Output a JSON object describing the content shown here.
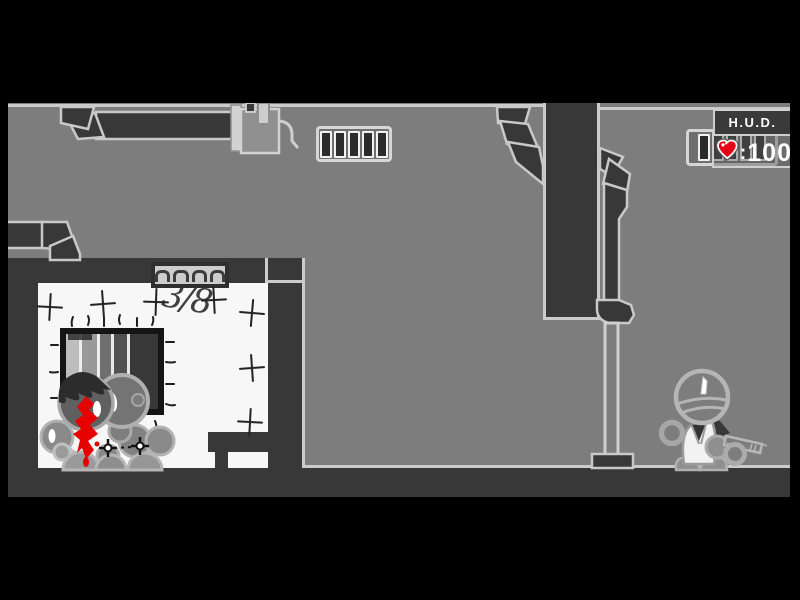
{
  "game": {
    "hud": {
      "title": "H.U.D.",
      "health_separator": ":",
      "health_value": "100",
      "heart_icon": "heart-health-icon",
      "heart_color": "#e60016"
    },
    "wall_text": "3/8",
    "vents": {
      "slot_count": 5
    },
    "colors": {
      "frame_black": "#000000",
      "background_gray": "#7d7d7d",
      "structure_dark": "#383838",
      "outline_light": "#cbcbcb",
      "room_white": "#f7f7f7",
      "blood_red": "#e60000"
    }
  }
}
